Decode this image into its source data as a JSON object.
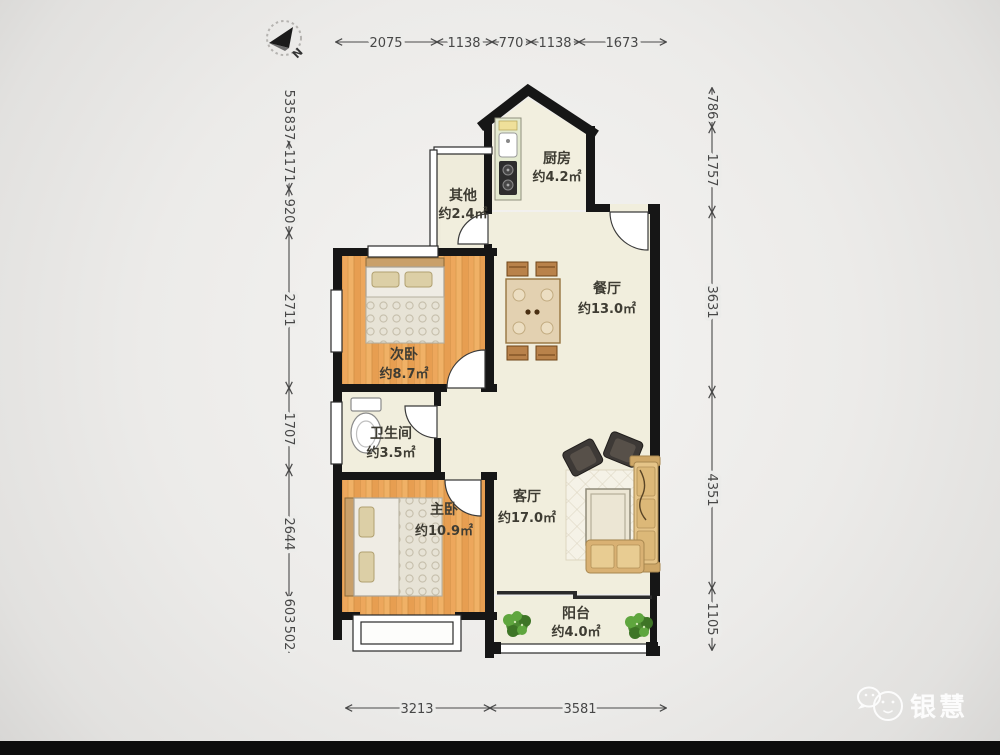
{
  "page": {
    "watermark": "银慧"
  },
  "compass": {
    "label": "N"
  },
  "floorplan": {
    "rooms": [
      {
        "key": "kitchen",
        "name": "厨房",
        "area": "约4.2㎡"
      },
      {
        "key": "other",
        "name": "其他",
        "area": "约2.4㎡"
      },
      {
        "key": "dining-room",
        "name": "餐厅",
        "area": "约13.0㎡"
      },
      {
        "key": "second-bedroom",
        "name": "次卧",
        "area": "约8.7㎡"
      },
      {
        "key": "bathroom",
        "name": "卫生间",
        "area": "约3.5㎡"
      },
      {
        "key": "living-room",
        "name": "客厅",
        "area": "约17.0㎡"
      },
      {
        "key": "master-bedroom",
        "name": "主卧",
        "area": "约10.9㎡"
      },
      {
        "key": "balcony",
        "name": "阳台",
        "area": "约4.0㎡"
      }
    ],
    "dimensions_mm": {
      "top": [
        "2075",
        "1138",
        "770",
        "1138",
        "1673"
      ],
      "left": [
        "535",
        "837",
        "1171",
        "920",
        "2711",
        "1707",
        "2644",
        "603",
        "502"
      ],
      "right": [
        "786",
        "1757",
        "3631",
        "4351",
        "1105"
      ],
      "bottom": [
        "3213",
        "3581"
      ]
    }
  },
  "colors": {
    "wall": "#161616",
    "room_fill": "#f1eedd",
    "wood_floor": "#eeab5e",
    "counter_green": "#e4ead0",
    "plant_green": "#4d8a32",
    "sofa_tan": "#e0bc7e",
    "dimension_text": "#474747",
    "background": "#ececea",
    "bottom_bar": "#0d0d0d"
  }
}
